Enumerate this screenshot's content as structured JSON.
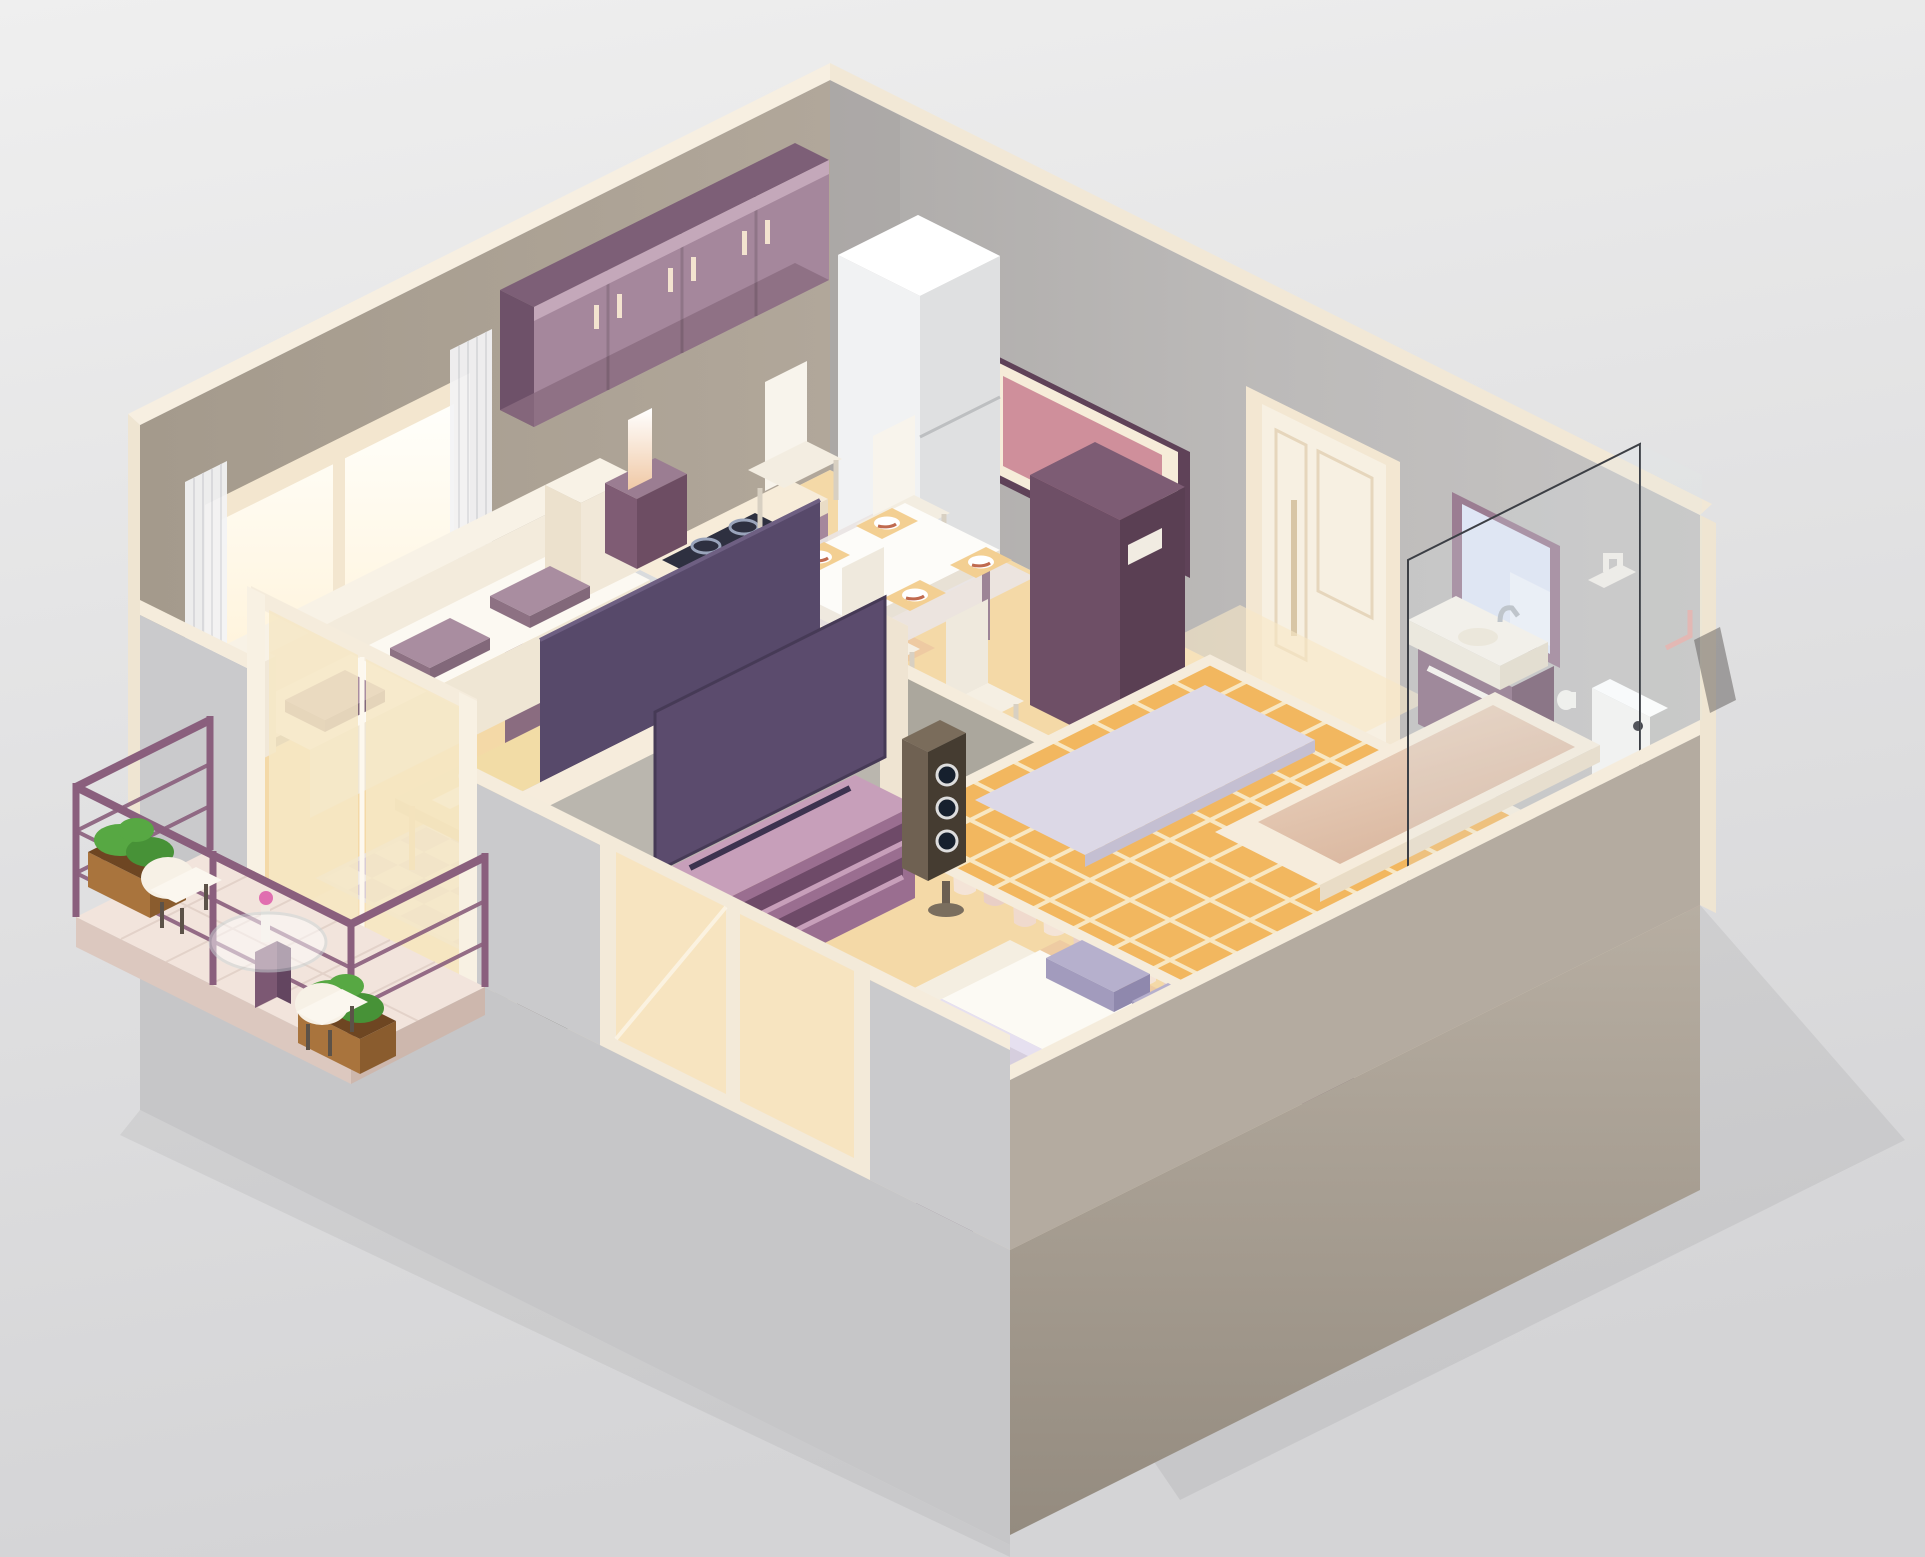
{
  "scene": {
    "type": "isometric-apartment-cutaway-illustration",
    "rooms": [
      {
        "name": "kitchen",
        "items": [
          "upper-cabinets",
          "refrigerator",
          "countertop",
          "sink",
          "faucet",
          "cooktop",
          "oven",
          "base-cabinets"
        ]
      },
      {
        "name": "dining-area",
        "items": [
          "dining-table",
          "four-chairs",
          "four-place-settings",
          "area-rug"
        ]
      },
      {
        "name": "living-room",
        "items": [
          "sofa",
          "three-cushions",
          "two-side-tables",
          "two-lamps",
          "coffee-table",
          "coffee-cups",
          "checkered-rug",
          "wall-mounted-tv",
          "floor-speakers",
          "window",
          "curtains"
        ]
      },
      {
        "name": "bedroom",
        "items": [
          "double-bed",
          "two-pillows",
          "blanket",
          "two-nightstands",
          "two-lamps",
          "tv-stand",
          "tv"
        ]
      },
      {
        "name": "closet",
        "items": [
          "shoe-shelf",
          "high-heels",
          "two-pairs-of-shoes",
          "clothes-rail",
          "hangers-with-clothes"
        ]
      },
      {
        "name": "bathroom",
        "items": [
          "wall-hung-vanity-sink",
          "mirror",
          "toilet",
          "toilet-paper-holder",
          "bath-mat",
          "bathtub",
          "glass-shower-screen",
          "towel-ring",
          "orange-tiled-floor"
        ]
      },
      {
        "name": "hallway",
        "items": [
          "entrance-door",
          "wardrobe-cabinet",
          "picture-frame"
        ]
      },
      {
        "name": "balcony",
        "items": [
          "purple-railing",
          "two-wooden-planters",
          "green-bushes",
          "round-glass-table",
          "flower-vase",
          "two-chairs",
          "sliding-glass-door"
        ]
      }
    ],
    "palette": {
      "bg_top": "#ededee",
      "bg_bottom": "#d5d5d7",
      "ground_shadow": "#c2c2c6",
      "wall_left": "#a89e91",
      "wall_right": "#bbb8b7",
      "wall_top_band": "#f5ecdc",
      "cut_wall_left": "#cacacc",
      "cut_wall_right": "#b4aba0",
      "floor_main": "#f4d9a7",
      "floor_salmon": "#eabf9e",
      "floor_light": "#f8e8c6",
      "tile_orange": "#f2b75f",
      "tile_grout": "#f8e7c2",
      "rug_check_a": "#d9ccd4",
      "rug_check_b": "#efe9e4",
      "rug_dining": "#eae5e4",
      "cabinet_plum": "#a5879c",
      "cabinet_plum_dark": "#7d5f77",
      "cabinet_crown": "#8f6d86",
      "counter_cream": "#f7ecd9",
      "appliance_dark": "#2e3040",
      "steel": "#c9cacd",
      "fridge_white": "#f1f2f3",
      "fridge_shade": "#dfe0e1",
      "table_white": "#fdfcf9",
      "chair_white": "#f8f4ec",
      "placemat_tan": "#f3cf92",
      "plate_accent": "#c06a4f",
      "frame_plum": "#5f4258",
      "frame_mat": "#f6ecd9",
      "frame_pink": "#cf8f9b",
      "door_cream": "#f7f0e2",
      "mirror_glass": "#dfe6f5",
      "vanity_plum": "#8d6f84",
      "fixture_white": "#f6f5f2",
      "sofa_cream": "#f3ebdc",
      "sofa_seat": "#fcf9f2",
      "cushion_purple": "#a98da0",
      "cushion_purple_dark": "#8d7183",
      "wood_light": "#f2dca6",
      "tv_dark": "#57496a",
      "tv_screen": "#5b4b6d",
      "partition_gray": "#bab6ae",
      "tv_stand_purple": "#9a6e90",
      "tv_stand_top": "#c79fba",
      "speaker_brown": "#453c31",
      "speaker_brown_light": "#6f6152",
      "bed_frame": "#f4eee1",
      "mattress_white": "#fcfaf4",
      "blanket_lavender": "#d6cede",
      "pillow_lavender": "#b6b0cd",
      "nightstand_plum": "#7f5c74",
      "lamp_white": "#ffffff",
      "closet_wall": "#aba79d",
      "hanger_purple": "#6d4a63",
      "clothes_cream": "#f4e4d7",
      "clothes_pink": "#e9cfc6",
      "shoe_dark": "#5a3a35",
      "railing_purple": "#8a5f7d",
      "planter_wood": "#a9743d",
      "bush_green": "#57a843",
      "glass_line": "#3c3f45",
      "tub_rim": "#f6ecdc",
      "towel_pink": "#e3b8b4",
      "window_glow": "#fffdf2"
    }
  }
}
